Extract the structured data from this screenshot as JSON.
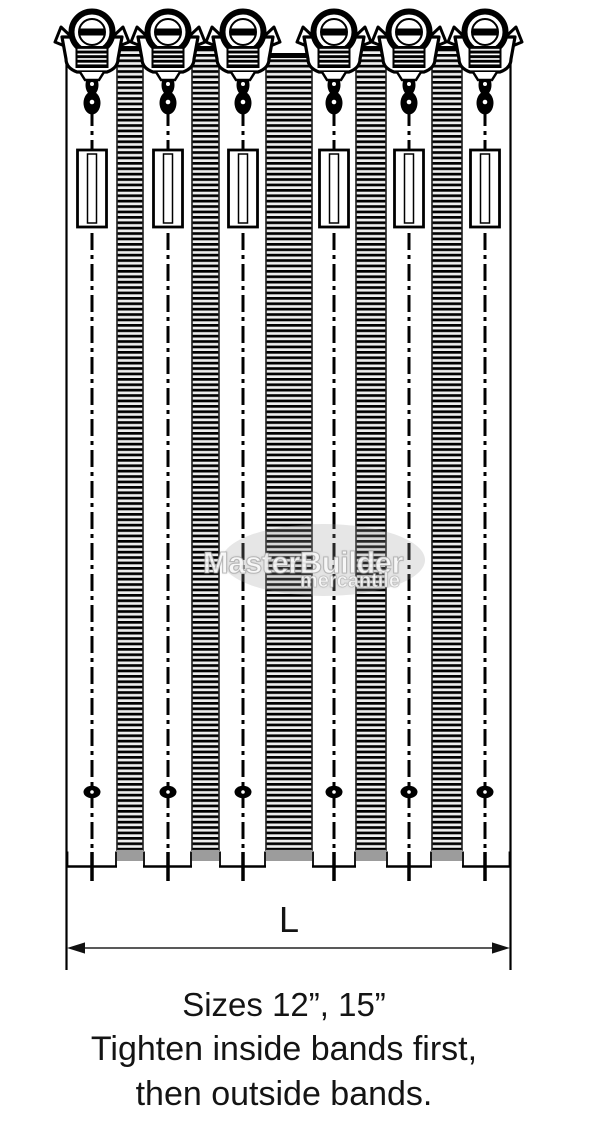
{
  "diagram": {
    "dimension_label": "L",
    "bolt_count": 6,
    "band_count": 5
  },
  "watermark": {
    "primary": "MasterBuilder",
    "secondary": "mercantile"
  },
  "caption": {
    "sizes": "Sizes 12”, 15”",
    "note_line1": "Tighten inside bands first,",
    "note_line2": "then outside bands."
  },
  "colors": {
    "ink": "#000000",
    "band_shadow": "#9c9c9c",
    "band_background": "#ededed",
    "watermark_ellipse": "rgba(155,155,155,0.25)",
    "watermark_text": "rgba(255,255,255,0.85)"
  }
}
